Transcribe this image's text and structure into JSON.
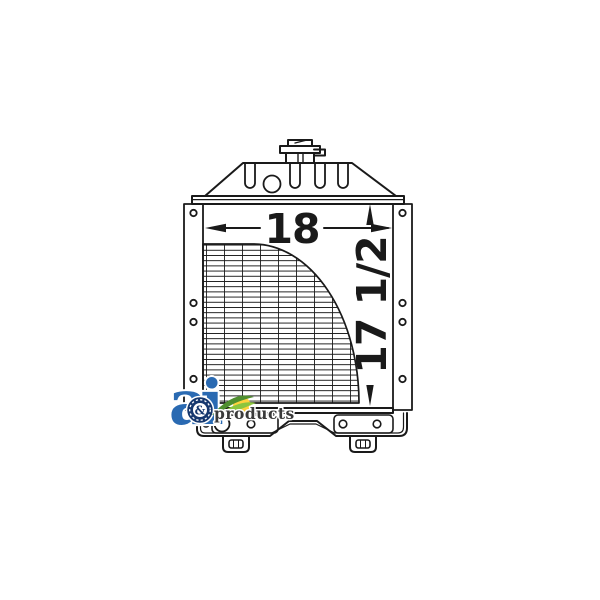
{
  "page": {
    "background": "#ffffff",
    "line_color": "#1a1a1a"
  },
  "annotations": {
    "width_dim": "18",
    "height_dim": "17 1/2"
  },
  "logo": {
    "letter_a": "a",
    "letter_i": "i",
    "ampersand": "&",
    "wordmark": "products",
    "colors": {
      "blue": "#2a6ab2",
      "navy": "#16386e",
      "green": "#8bc53f",
      "green_dark": "#4f8f2f",
      "yellow": "#ffd23e",
      "text": "#3a3a3a"
    }
  }
}
